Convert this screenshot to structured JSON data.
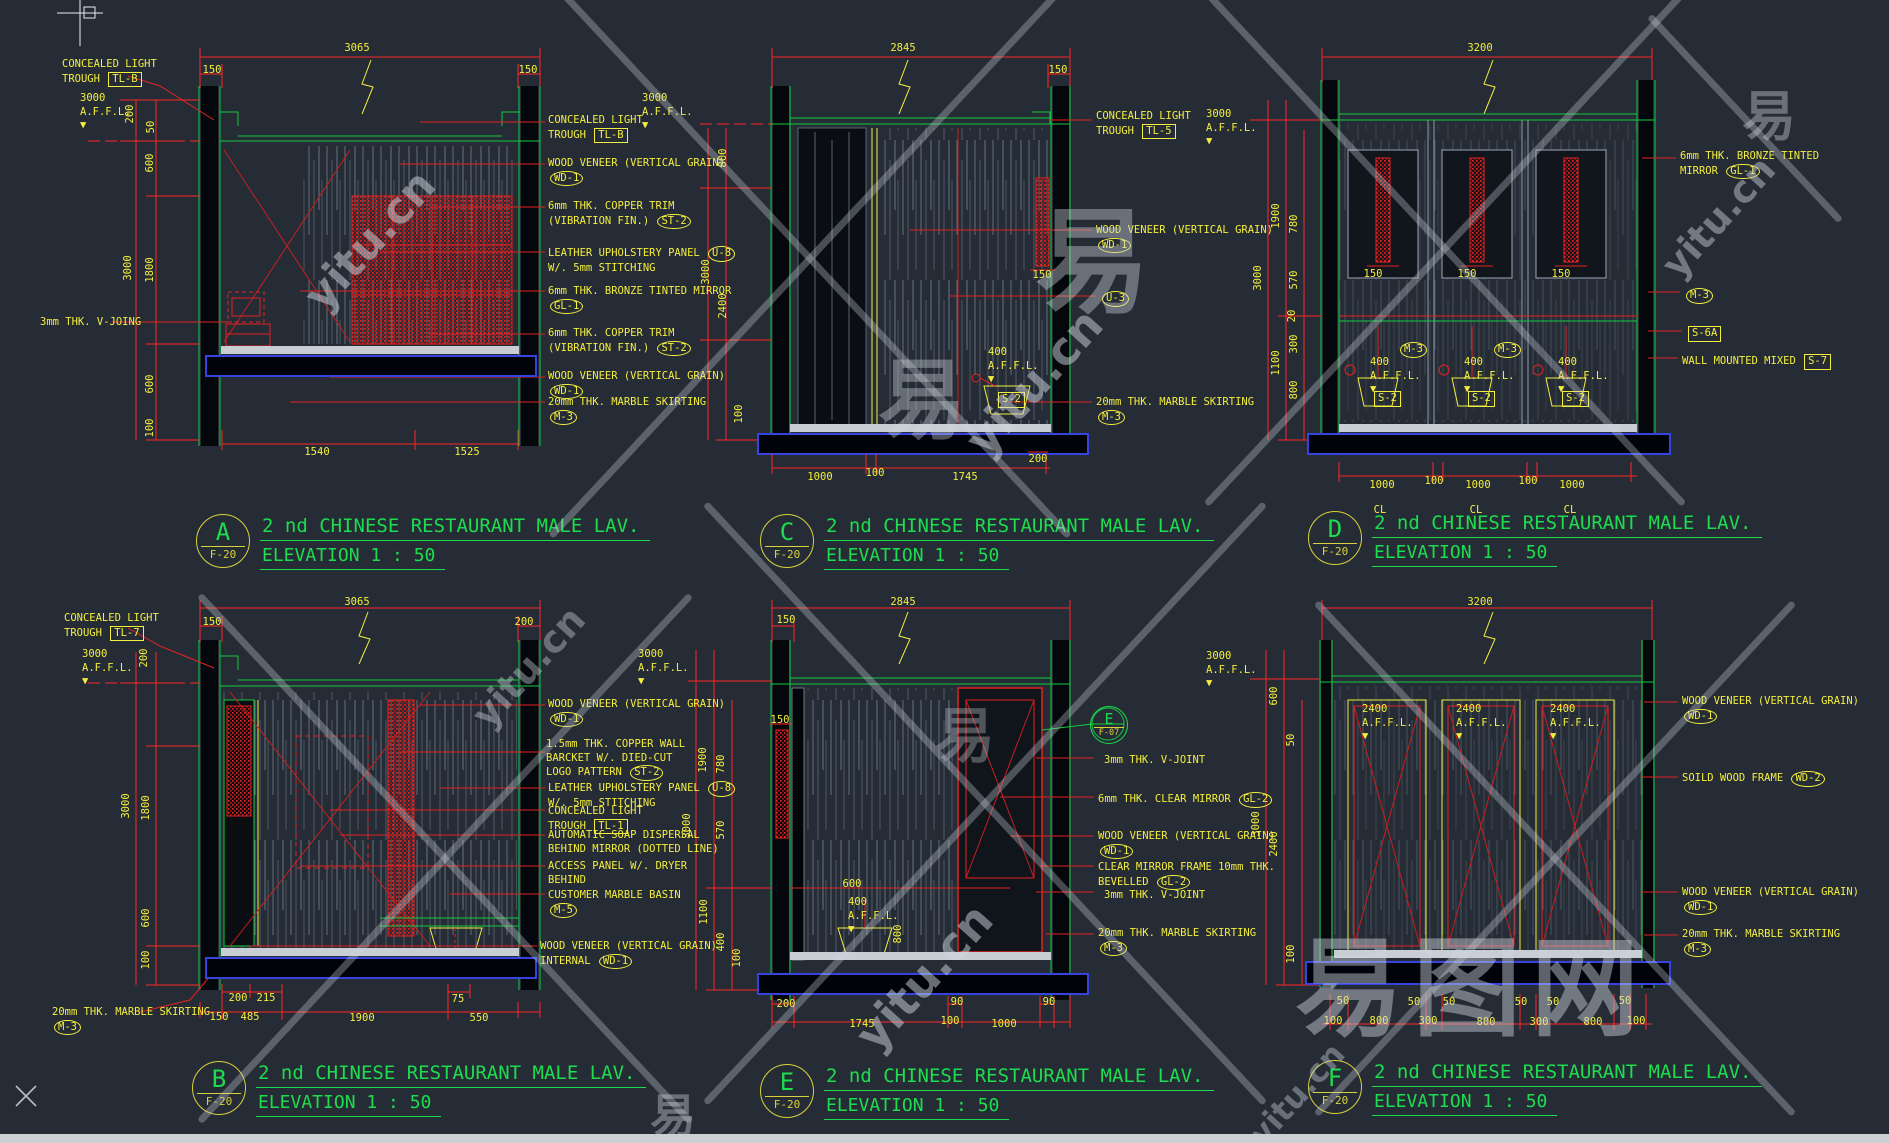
{
  "app": {
    "background": "#252c36"
  },
  "colors": {
    "red": "#ff2626",
    "green": "#14c83f",
    "yellow": "#f4ee3e",
    "title_green": "#1ddd4e",
    "floor_blue": "#3544e0",
    "veneer_gray": "#93a2b2",
    "watermark": "#cfd6de"
  },
  "titles": [
    {
      "letter": "A",
      "sheet": "F-20",
      "line1": "2 nd CHINESE RESTAURANT MALE LAV.",
      "line2": "ELEVATION  1 : 50"
    },
    {
      "letter": "C",
      "sheet": "F-20",
      "line1": "2 nd CHINESE RESTAURANT MALE LAV.",
      "line2": "ELEVATION  1 : 50"
    },
    {
      "letter": "D",
      "sheet": "F-20",
      "line1": "2 nd CHINESE RESTAURANT MALE LAV.",
      "line2": "ELEVATION  1 : 50"
    },
    {
      "letter": "B",
      "sheet": "F-20",
      "line1": "2 nd CHINESE RESTAURANT MALE LAV.",
      "line2": "ELEVATION  1 : 50"
    },
    {
      "letter": "E",
      "sheet": "F-20",
      "line1": "2 nd CHINESE RESTAURANT MALE LAV.",
      "line2": "ELEVATION  1 : 50"
    },
    {
      "letter": "F",
      "sheet": "F-20",
      "line1": "2 nd CHINESE RESTAURANT MALE LAV.",
      "line2": "ELEVATION  1 : 50"
    }
  ],
  "detail_badge": {
    "letter": "E",
    "sheet": "F-07"
  },
  "annotations": [
    {
      "t": "CONCEALED LIGHT\nTROUGH {box:TL-B}",
      "x": 62,
      "y": 58
    },
    {
      "t": "3000\nA.F.F.L.\n▼",
      "x": 80,
      "y": 92
    },
    {
      "t": "3mm THK. V-JOING",
      "x": 40,
      "y": 316
    },
    {
      "t": "CONCEALED LIGHT\nTROUGH {box:TL-B}",
      "x": 548,
      "y": 114
    },
    {
      "t": "WOOD VENEER (VERTICAL GRAIN)\n{oval:WD-1}",
      "x": 548,
      "y": 157
    },
    {
      "t": "6mm THK. COPPER TRIM\n(VIBRATION FIN.) {oval:ST-2}",
      "x": 548,
      "y": 200
    },
    {
      "t": "LEATHER UPHOLSTERY PANEL {oval:U-8}\nW/. 5mm STITCHING",
      "x": 548,
      "y": 246
    },
    {
      "t": "6mm THK. BRONZE TINTED MIRROR\n{oval:GL-1}",
      "x": 548,
      "y": 285
    },
    {
      "t": "6mm THK. COPPER TRIM\n(VIBRATION FIN.) {oval:ST-2}",
      "x": 548,
      "y": 327
    },
    {
      "t": "WOOD VENEER (VERTICAL GRAIN)\n{oval:WD-1}",
      "x": 548,
      "y": 370
    },
    {
      "t": "20mm THK. MARBLE SKIRTING\n{oval:M-3}",
      "x": 548,
      "y": 396
    },
    {
      "t": "3000\nA.F.F.L.\n▼",
      "x": 642,
      "y": 92
    },
    {
      "t": "CONCEALED LIGHT\nTROUGH {box:TL-5}",
      "x": 1096,
      "y": 110
    },
    {
      "t": "WOOD VENEER (VERTICAL GRAIN)\n{oval:WD-1}",
      "x": 1096,
      "y": 224
    },
    {
      "t": "{oval:U-3}",
      "x": 1100,
      "y": 291
    },
    {
      "t": "20mm THK. MARBLE SKIRTING\n{oval:M-3}",
      "x": 1096,
      "y": 396
    },
    {
      "t": "400\nA.F.F.L.\n▼",
      "x": 988,
      "y": 346
    },
    {
      "t": "{box:S-2}",
      "x": 996,
      "y": 392
    },
    {
      "t": "3000\nA.F.F.L.\n▼",
      "x": 1206,
      "y": 108
    },
    {
      "t": "6mm THK. BRONZE TINTED\nMIRROR {oval:GL-1}",
      "x": 1680,
      "y": 150
    },
    {
      "t": "{oval:M-3}",
      "x": 1684,
      "y": 288
    },
    {
      "t": "{box:S-6A}",
      "x": 1686,
      "y": 326
    },
    {
      "t": "WALL MOUNTED MIXED {box:S-7}",
      "x": 1682,
      "y": 354
    },
    {
      "t": "{oval:M-3}",
      "x": 1398,
      "y": 342
    },
    {
      "t": "{oval:M-3}",
      "x": 1492,
      "y": 342
    },
    {
      "t": "400\nA.F.F.L.\n▼",
      "x": 1370,
      "y": 356
    },
    {
      "t": "400\nA.F.F.L.\n▼",
      "x": 1464,
      "y": 356
    },
    {
      "t": "400\nA.F.F.L.\n▼",
      "x": 1558,
      "y": 356
    },
    {
      "t": "{box:S-2}",
      "x": 1372,
      "y": 391
    },
    {
      "t": "{box:S-2}",
      "x": 1466,
      "y": 391
    },
    {
      "t": "{box:S-2}",
      "x": 1560,
      "y": 391
    },
    {
      "t": "CONCEALED LIGHT\nTROUGH {box:TL-7}",
      "x": 64,
      "y": 612
    },
    {
      "t": "3000\nA.F.F.L.\n▼",
      "x": 82,
      "y": 648
    },
    {
      "t": "WOOD VENEER (VERTICAL GRAIN)\n{oval:WD-1}",
      "x": 548,
      "y": 698
    },
    {
      "t": "1.5mm THK. COPPER WALL\nBARCKET W/. DIED-CUT\nLOGO PATTERN {oval:ST-2}",
      "x": 546,
      "y": 738
    },
    {
      "t": "LEATHER UPHOLSTERY PANEL {oval:U-8}\nW/. 5mm STITCHING",
      "x": 548,
      "y": 781
    },
    {
      "t": "CONCEALED LIGHT\nTROUGH {box:TL-1}",
      "x": 548,
      "y": 805
    },
    {
      "t": "AUTOMATIC SOAP DISPERSAL\nBEHIND MIRROR (DOTTED LINE)",
      "x": 548,
      "y": 829
    },
    {
      "t": "ACCESS PANEL W/. DRYER\nBEHIND",
      "x": 548,
      "y": 860
    },
    {
      "t": "CUSTOMER MARBLE BASIN\n{oval:M-5}",
      "x": 548,
      "y": 889
    },
    {
      "t": "WOOD VENEER (VERTICAL GRAIN)\nINTERNAL {oval:WD-1}",
      "x": 540,
      "y": 940
    },
    {
      "t": "20mm THK. MARBLE SKIRTING\n{oval:M-3}",
      "x": 52,
      "y": 1006
    },
    {
      "t": "3000\nA.F.F.L.\n▼",
      "x": 638,
      "y": 648
    },
    {
      "t": "3mm THK. V-JOINT",
      "x": 1104,
      "y": 754
    },
    {
      "t": "6mm THK. CLEAR MIRROR  {oval:GL-2}",
      "x": 1098,
      "y": 792
    },
    {
      "t": "WOOD VENEER (VERTICAL GRAIN)\n{oval:WD-1}",
      "x": 1098,
      "y": 830
    },
    {
      "t": "CLEAR MIRROR FRAME 10mm THK.\nBEVELLED {oval:GL-2}",
      "x": 1098,
      "y": 861
    },
    {
      "t": "3mm THK. V-JOINT",
      "x": 1104,
      "y": 889
    },
    {
      "t": "20mm THK. MARBLE SKIRTING\n{oval:M-3}",
      "x": 1098,
      "y": 927
    },
    {
      "t": "400\nA.F.F.L.\n▼",
      "x": 848,
      "y": 896
    },
    {
      "t": "3000\nA.F.F.L.\n▼",
      "x": 1206,
      "y": 650
    },
    {
      "t": "2400\nA.F.F.L.\n▼",
      "x": 1362,
      "y": 703
    },
    {
      "t": "2400\nA.F.F.L.\n▼",
      "x": 1456,
      "y": 703
    },
    {
      "t": "2400\nA.F.F.L.\n▼",
      "x": 1550,
      "y": 703
    },
    {
      "t": "WOOD VENEER (VERTICAL GRAIN)\n{oval:WD-1}",
      "x": 1682,
      "y": 695
    },
    {
      "t": "SOILD WOOD FRAME  {oval:WD-2}",
      "x": 1682,
      "y": 771
    },
    {
      "t": "WOOD VENEER (VERTICAL GRAIN)\n{oval:WD-1}",
      "x": 1682,
      "y": 886
    },
    {
      "t": "20mm THK. MARBLE SKIRTING\n{oval:M-3}",
      "x": 1682,
      "y": 928
    }
  ],
  "dims": [
    {
      "t": "3065",
      "x": 357,
      "y": 48
    },
    {
      "t": "150",
      "x": 212,
      "y": 70
    },
    {
      "t": "150",
      "x": 528,
      "y": 70
    },
    {
      "t": "1540",
      "x": 317,
      "y": 452
    },
    {
      "t": "1525",
      "x": 467,
      "y": 452
    },
    {
      "t": "200",
      "x": 130,
      "y": 114,
      "v": 1
    },
    {
      "t": "50",
      "x": 151,
      "y": 127,
      "v": 1
    },
    {
      "t": "600",
      "x": 150,
      "y": 163,
      "v": 1
    },
    {
      "t": "3000",
      "x": 128,
      "y": 268,
      "v": 1
    },
    {
      "t": "1800",
      "x": 150,
      "y": 270,
      "v": 1
    },
    {
      "t": "600",
      "x": 150,
      "y": 384,
      "v": 1
    },
    {
      "t": "100",
      "x": 150,
      "y": 428,
      "v": 1
    },
    {
      "t": "2845",
      "x": 903,
      "y": 48
    },
    {
      "t": "150",
      "x": 1058,
      "y": 70
    },
    {
      "t": "150",
      "x": 1042,
      "y": 275
    },
    {
      "t": "1000",
      "x": 820,
      "y": 477
    },
    {
      "t": "100",
      "x": 875,
      "y": 473
    },
    {
      "t": "1745",
      "x": 965,
      "y": 477
    },
    {
      "t": "200",
      "x": 1038,
      "y": 459
    },
    {
      "t": "800",
      "x": 723,
      "y": 158,
      "v": 1
    },
    {
      "t": "3000",
      "x": 706,
      "y": 272,
      "v": 1
    },
    {
      "t": "2400",
      "x": 723,
      "y": 306,
      "v": 1
    },
    {
      "t": "100",
      "x": 739,
      "y": 414,
      "v": 1
    },
    {
      "t": "3200",
      "x": 1480,
      "y": 48
    },
    {
      "t": "150",
      "x": 1373,
      "y": 274
    },
    {
      "t": "150",
      "x": 1467,
      "y": 274
    },
    {
      "t": "150",
      "x": 1561,
      "y": 274
    },
    {
      "t": "1000",
      "x": 1382,
      "y": 485
    },
    {
      "t": "100",
      "x": 1434,
      "y": 481
    },
    {
      "t": "1000",
      "x": 1478,
      "y": 485
    },
    {
      "t": "100",
      "x": 1528,
      "y": 481
    },
    {
      "t": "1000",
      "x": 1572,
      "y": 485
    },
    {
      "t": "CL",
      "x": 1380,
      "y": 510
    },
    {
      "t": "CL",
      "x": 1476,
      "y": 510
    },
    {
      "t": "CL",
      "x": 1570,
      "y": 510
    },
    {
      "t": "1900",
      "x": 1276,
      "y": 216,
      "v": 1
    },
    {
      "t": "780",
      "x": 1294,
      "y": 224,
      "v": 1
    },
    {
      "t": "3000",
      "x": 1258,
      "y": 278,
      "v": 1
    },
    {
      "t": "570",
      "x": 1294,
      "y": 280,
      "v": 1
    },
    {
      "t": "20",
      "x": 1292,
      "y": 316,
      "v": 1
    },
    {
      "t": "300",
      "x": 1294,
      "y": 344,
      "v": 1
    },
    {
      "t": "1100",
      "x": 1276,
      "y": 363,
      "v": 1
    },
    {
      "t": "800",
      "x": 1294,
      "y": 390,
      "v": 1
    },
    {
      "t": "3065",
      "x": 357,
      "y": 602
    },
    {
      "t": "150",
      "x": 212,
      "y": 622
    },
    {
      "t": "200",
      "x": 524,
      "y": 622
    },
    {
      "t": "200",
      "x": 238,
      "y": 998
    },
    {
      "t": "215",
      "x": 266,
      "y": 998
    },
    {
      "t": "75",
      "x": 458,
      "y": 999
    },
    {
      "t": "150",
      "x": 219,
      "y": 1017
    },
    {
      "t": "485",
      "x": 250,
      "y": 1017
    },
    {
      "t": "1900",
      "x": 362,
      "y": 1018
    },
    {
      "t": "550",
      "x": 479,
      "y": 1018
    },
    {
      "t": "200",
      "x": 144,
      "y": 658,
      "v": 1
    },
    {
      "t": "3000",
      "x": 126,
      "y": 806,
      "v": 1
    },
    {
      "t": "1800",
      "x": 146,
      "y": 808,
      "v": 1
    },
    {
      "t": "600",
      "x": 146,
      "y": 918,
      "v": 1
    },
    {
      "t": "100",
      "x": 146,
      "y": 960,
      "v": 1
    },
    {
      "t": "2845",
      "x": 903,
      "y": 602
    },
    {
      "t": "150",
      "x": 786,
      "y": 620
    },
    {
      "t": "150",
      "x": 780,
      "y": 720
    },
    {
      "t": "600",
      "x": 852,
      "y": 884
    },
    {
      "t": "800",
      "x": 898,
      "y": 934,
      "v": 1
    },
    {
      "t": "200",
      "x": 786,
      "y": 1004
    },
    {
      "t": "90",
      "x": 957,
      "y": 1002
    },
    {
      "t": "90",
      "x": 1049,
      "y": 1002
    },
    {
      "t": "1745",
      "x": 862,
      "y": 1024
    },
    {
      "t": "100",
      "x": 950,
      "y": 1021
    },
    {
      "t": "1000",
      "x": 1004,
      "y": 1024
    },
    {
      "t": "1900",
      "x": 703,
      "y": 760,
      "v": 1
    },
    {
      "t": "780",
      "x": 721,
      "y": 764,
      "v": 1
    },
    {
      "t": "3000",
      "x": 687,
      "y": 826,
      "v": 1
    },
    {
      "t": "570",
      "x": 721,
      "y": 830,
      "v": 1
    },
    {
      "t": "1100",
      "x": 704,
      "y": 912,
      "v": 1
    },
    {
      "t": "400",
      "x": 721,
      "y": 942,
      "v": 1
    },
    {
      "t": "100",
      "x": 737,
      "y": 958,
      "v": 1
    },
    {
      "t": "3200",
      "x": 1480,
      "y": 602
    },
    {
      "t": "600",
      "x": 1274,
      "y": 696,
      "v": 1
    },
    {
      "t": "50",
      "x": 1291,
      "y": 740,
      "v": 1
    },
    {
      "t": "3000",
      "x": 1256,
      "y": 824,
      "v": 1
    },
    {
      "t": "2400",
      "x": 1274,
      "y": 844,
      "v": 1
    },
    {
      "t": "100",
      "x": 1291,
      "y": 954,
      "v": 1
    },
    {
      "t": "50",
      "x": 1343,
      "y": 1001
    },
    {
      "t": "50",
      "x": 1414,
      "y": 1002
    },
    {
      "t": "50",
      "x": 1449,
      "y": 1002
    },
    {
      "t": "50",
      "x": 1521,
      "y": 1002
    },
    {
      "t": "50",
      "x": 1553,
      "y": 1002
    },
    {
      "t": "50",
      "x": 1625,
      "y": 1001
    },
    {
      "t": "100",
      "x": 1333,
      "y": 1021
    },
    {
      "t": "800",
      "x": 1379,
      "y": 1021
    },
    {
      "t": "300",
      "x": 1428,
      "y": 1021
    },
    {
      "t": "800",
      "x": 1486,
      "y": 1022
    },
    {
      "t": "300",
      "x": 1539,
      "y": 1022
    },
    {
      "t": "800",
      "x": 1593,
      "y": 1022
    },
    {
      "t": "100",
      "x": 1636,
      "y": 1021
    }
  ],
  "watermarks": {
    "texts": [
      {
        "t": "yitu.cn",
        "x": 285,
        "y": 215,
        "s": 44,
        "r": -48,
        "o": 0.5
      },
      {
        "t": "yitu.cn",
        "x": 945,
        "y": 355,
        "s": 46,
        "r": -48,
        "o": 0.5
      },
      {
        "t": "yitu.cn",
        "x": 835,
        "y": 950,
        "s": 46,
        "r": -48,
        "o": 0.5
      },
      {
        "t": "yitu.cn",
        "x": 1645,
        "y": 195,
        "s": 38,
        "r": -48,
        "o": 0.45
      },
      {
        "t": "yitu.cn",
        "x": 455,
        "y": 645,
        "s": 38,
        "r": -48,
        "o": 0.4
      },
      {
        "t": "yitu.cn",
        "x": 1235,
        "y": 1075,
        "s": 32,
        "r": -48,
        "o": 0.4
      },
      {
        "t": "易",
        "x": 1035,
        "y": 170,
        "s": 115,
        "r": 0,
        "o": 0.4
      },
      {
        "t": "易",
        "x": 878,
        "y": 330,
        "s": 88,
        "r": 0,
        "o": 0.38
      },
      {
        "t": "易",
        "x": 1742,
        "y": 72,
        "s": 54,
        "r": 0,
        "o": 0.4
      },
      {
        "t": "易",
        "x": 650,
        "y": 1080,
        "s": 46,
        "r": 0,
        "o": 0.4
      },
      {
        "t": "易",
        "x": 935,
        "y": 688,
        "s": 60,
        "r": 0,
        "o": 0.33
      },
      {
        "t": "易图网",
        "x": 1295,
        "y": 902,
        "s": 108,
        "r": 0,
        "o": 0.45
      }
    ]
  }
}
